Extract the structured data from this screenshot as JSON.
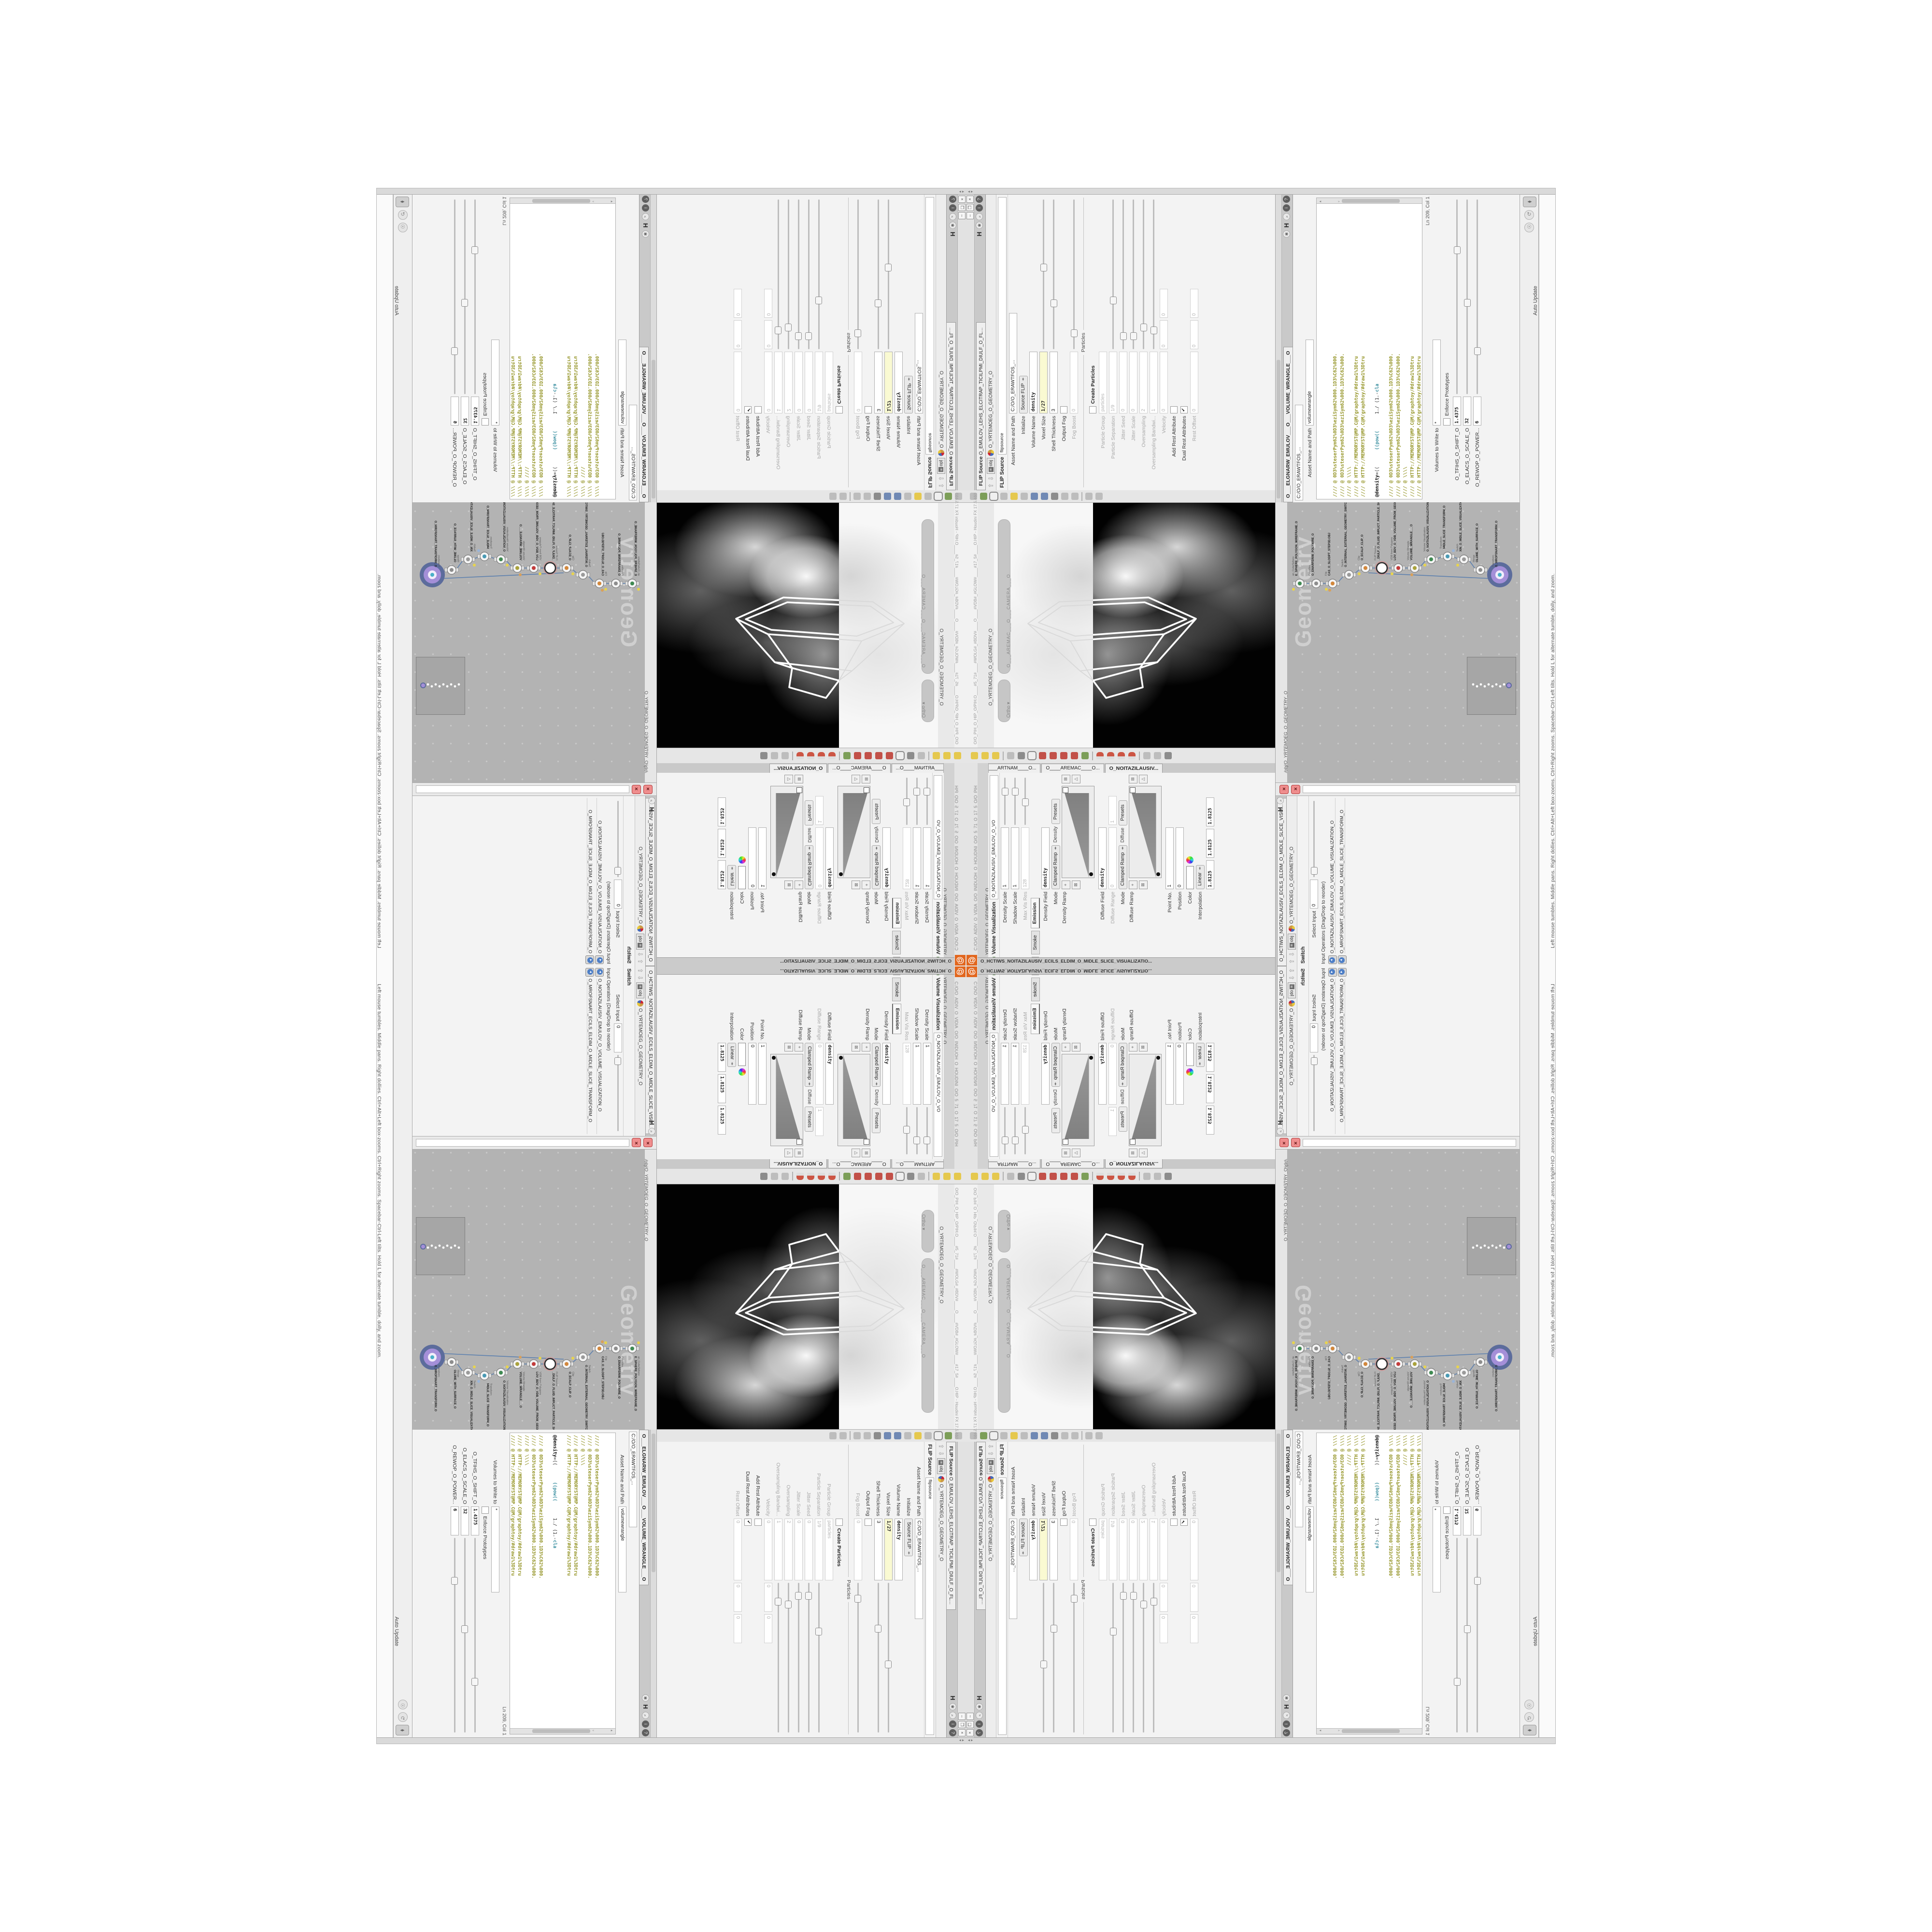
{
  "edges": {
    "help_text": "Left mouse tumbles. Middle pans. Right dollies. Ctrl+Alt+Left box-zooms. Ctrl+Right zooms. Spacebar-Ctrl-Left tilts. Hold L for alternate tumble, dolly, and zoom.",
    "status_path": "C:/O/O_AIDIV_O_VIDIA_O/O_INIDUOH_O_HOUDINI_O/O_5_71_O_17_5_O/O_PIH",
    "auto_update": "Auto Update",
    "scroll_arrows": "◂ ▸"
  },
  "flip_pane": {
    "tab_title": "FLIP Source",
    "tab_name": "O_EMULOV_LEHS_ELCITRAP_TICILPMI_DIULF_O_FLUID_IMPLICIT_PARTICLE_SHEL_VOLUME_O",
    "path_context": "obj",
    "path_label": "O_YRTEMOEG_O_GEOMETRY_O",
    "node_title": "FLIP Source",
    "node_name": "flipsource",
    "rows": [
      {
        "l": "Asset Name and Path",
        "v": "C:/O/O_ERAWTFOS_...",
        "t": "f",
        "wide": true
      },
      {
        "l": "Initialize",
        "v": "Source FLIP",
        "t": "dd"
      },
      {
        "l": "Volume Name",
        "v": "density",
        "t": "f",
        "b": 1
      },
      {
        "l": "Voxel Size",
        "v": "1/27",
        "t": "f",
        "y": 1,
        "s": 0.52
      },
      {
        "l": "Shell Thickness",
        "v": "3",
        "t": "f",
        "s": 0.28
      },
      {
        "l": "Output Fog",
        "t": "c"
      },
      {
        "l": "Fog Boost",
        "v": "0",
        "t": "f",
        "d": 1,
        "s": 0.08
      },
      {
        "l": "Particles",
        "t": "sep"
      },
      {
        "l": "Create Particles",
        "t": "cb"
      },
      {
        "l": "Particle Group",
        "v": "particles",
        "t": "f",
        "d": 1
      },
      {
        "l": "Particle Separation",
        "v": "1/9",
        "t": "f",
        "d": 1,
        "s": 0.3
      },
      {
        "l": "Jitter Seed",
        "v": "0",
        "t": "f",
        "d": 1,
        "s": 0.06
      },
      {
        "l": "Jitter Scale",
        "v": "0",
        "t": "f",
        "d": 1,
        "s": 0.06
      },
      {
        "l": "Oversampling",
        "v": "2",
        "t": "f",
        "d": 1,
        "s": 0.12
      },
      {
        "l": "Oversampling Bandwi...",
        "v": "1",
        "t": "f",
        "d": 1,
        "s": 0.1
      },
      {
        "l": "Velocity",
        "v": "0",
        "v2": [
          "0",
          "0"
        ],
        "t": "f3",
        "d": 1
      },
      {
        "l": "Add Rest Attribute",
        "t": "c"
      },
      {
        "l": "Dual Rest Attributes",
        "t": "c",
        "chk": 1
      },
      {
        "l": "Rest Offset",
        "v": "0",
        "v2": [
          "0",
          "0"
        ],
        "t": "f3",
        "d": 1
      }
    ]
  },
  "wrangle_pane": {
    "tab_name": "O___ELGNARW_EMULOV___O___VOLUME_WRANGLE___O",
    "path_field": "C:/O/O_ERAWTFOS_...",
    "path_context": "obj",
    "path_label": "O_YRTEMOEG_O_GEOMETRY_O",
    "asset_label": "Asset Name and Path",
    "asset_value": "volumewrangle",
    "code_lines": [
      [
        [
          "com",
          "//// @ 0D3%steserPym62%0D3%eziSym62%000.1D3%C62%000."
        ]
      ],
      [
        [
          "com",
          "//// @ 0D3%steserPym62%0D3%eziSym62%000.1D3%C62%000."
        ]
      ],
      [
        [
          "com",
          "//// @ \\\\\\\\"
        ]
      ],
      [
        [
          "com",
          "//// @ HTTP://MEMORYST@MP.C@M/graphtoy/#draw1%3Dtru"
        ]
      ],
      [
        [
          "com",
          "//// @ HTTP://MEMORYST@MP.C@M/graphtoy/#draw1%3Dtru"
        ]
      ],
      [],
      [
        [
          "k",
          "@density"
        ],
        [
          "p",
          "=((      "
        ],
        [
          "fn",
          "((pow(("
        ],
        [
          "p",
          "      1./ (1.-"
        ],
        [
          "fn",
          "cla"
        ]
      ],
      [],
      [
        [
          "com",
          "//// @ 0D3%steserPym62%0D3%eziSym62%000.1D3%C62%000."
        ]
      ],
      [
        [
          "com",
          "//// @ 0D3%steserPym62%0D3%eziSym62%000.1D3%C62%000."
        ]
      ],
      [
        [
          "com",
          "//// @ \\\\\\\\"
        ]
      ],
      [
        [
          "com",
          "//// @ HTTP://MEMORYST@MP.C@M/graphtoy/#draw1%3Dtru"
        ]
      ],
      [
        [
          "com",
          "//// @ HTTP://MEMORYST@MP.C@M/graphtoy/#draw1%3Dtru"
        ]
      ]
    ],
    "status": "Ln 209, Col 1",
    "volumes_label": "Volumes to Write to",
    "volumes_value": "*",
    "enforce_label": "Enforce Prototypes",
    "sliders": [
      {
        "l": "O_TFIHS_O_SHIFT_O",
        "v": "1.4375",
        "s": 0.72
      },
      {
        "l": "O_ELACS_O_SCALE_O",
        "v": "32",
        "s": 0.45
      },
      {
        "l": "O_REWOP_O_POWER...",
        "v": "6",
        "s": 0.2
      }
    ]
  },
  "viewport": {
    "camera_pill": "O___AREMAC___O___CAMERA___O",
    "ortho_label": "Ortho ▾",
    "overlay_text": "O/O_PIH_O_HIP_O/PIH.O____#5_71#____#WOLG#_#BDV#____O____#VDB#_#GLOW#____#17_5#____O.HIP - Houdini FX 17.5.460",
    "path_context": "obj",
    "path_label": "O_YRTEMOEG_O_GEOMETRY_O",
    "toolbar_top": [
      "select-arrow-icon",
      "brush-icon",
      "lock-box-icon",
      "pose-icon",
      "light-bulb-icon",
      "light-bulb2-icon",
      "camera-icon",
      "camera2-icon",
      "render-region-icon",
      "snapshot-icon",
      "material-icon",
      "divider",
      "hand-icon",
      "grid-icon"
    ],
    "toolbar_bottom": [
      "cone-light-icon",
      "diamond-light-icon",
      "sky-light-icon",
      "divider",
      "back-arrow-icon",
      "construction-plane-icon",
      "selection-box-icon",
      "axis-handle-icon",
      "pivot-handle-icon",
      "peak-handle-icon",
      "wire-blast-icon",
      "rgb-axis-icon",
      "divider",
      "magnet-grid-icon",
      "magnet-prim-icon",
      "magnet-point-icon",
      "magnet-multi-icon",
      "divider",
      "forward-arrow-icon",
      "select-visible-icon",
      "compass-icon"
    ]
  },
  "network": {
    "watermark": "Geometry",
    "context_path": "/obj/O_YRTEMOEG_O_GEOMETRY_O",
    "path_context": "obj",
    "nodes": [
      {
        "type": "an_CubeSphere",
        "name": "E_SPHERE_POLYGON_WIREFRAME_O",
        "icon": "#3f8a52"
      },
      {
        "type": "PolyWire",
        "name": "O_EMARFERIW_POLYWIRE_O",
        "icon": "#8d8d8d"
      },
      {
        "type": "File",
        "name": "CAS_O_SLODPT_STEP3D.OBJ",
        "icon": "#d2873c"
      },
      {
        "type": "Switch",
        "name": "O_INTERNAL_EXTERNAL_GEOMETRY_SWITCH_O",
        "icon": "#9a9a9a"
      },
      {
        "type": "Clip",
        "name": "O_ECALP_CLIP_O",
        "icon": "#d2873c"
      },
      {
        "type": "FLIP Source",
        "name": "_DIULF_O_FLUID_IMPLICT_PARTICLE_SHEL_VOLUME_",
        "icon": "ring"
      },
      {
        "type": "VDB from Polygons",
        "name": "LOV_BDV_O_VDB_VOLUME_FROM_GEOMETRY_POLYG",
        "icon": "#c23c3c"
      },
      {
        "type": "Volume Wrangle",
        "name": "VOLUME_WRANGLE___O",
        "icon": "#aaa23c"
      },
      {
        "type": "Volume Visualization",
        "name": "O_NOITAZILAUSIV_VISUALIZATION_O",
        "icon": "#3f8a52"
      },
      {
        "type": "Transform",
        "name": "MIDLE_SLICE_TRANSFORM_O",
        "icon": "#4a9ab4"
      },
      {
        "type": "Switch",
        "name": "XIN_O_MIDLE_SLICE_VISUALIZATION_SWITCH_O",
        "icon": "#9a9a9a"
      },
      {
        "type": "Merge",
        "name": "OLUME_WITH_SURFACE_O",
        "icon": "#8d8d8d"
      },
      {
        "type": "Transform",
        "name": "O_MROFSNART_TRANSFORM_O",
        "icon": "purple"
      }
    ]
  },
  "volviz_pane": {
    "tabs": [
      "O____ARTNAM____O...",
      "O____AREMAC____O...",
      "O_NOITAZILAUSIV..."
    ],
    "active_tab": 2,
    "tab_name": "O_NOITAZILAUSIV_EMULOV_O_VO",
    "path_context": "obj",
    "path_label": "O_YRTEMOEG_O_GEOMETRY_O",
    "node_title": "Volume Visualization",
    "rows": [
      {
        "l": "Density Scale",
        "v": "1",
        "t": "f",
        "s": 0.62
      },
      {
        "l": "Shadow Scale",
        "v": "1",
        "t": "f",
        "s": 0.62
      },
      {
        "l": "Max Vis Res",
        "v": "128",
        "t": "f",
        "d": 1,
        "s": 0.4
      },
      {
        "t": "tabs",
        "tabs": [
          "Smoke",
          "Emission"
        ],
        "active": 1
      },
      {
        "l": "Density Field",
        "v": "density",
        "t": "f",
        "b": 1
      },
      {
        "l": "Mode",
        "v": "Clamped Ramp",
        "t": "mode",
        "extra": "Density",
        "btn": "Presets"
      },
      {
        "l": "Density Ramp",
        "t": "ramp"
      },
      {
        "l": "Diffuse Field",
        "v": "density",
        "t": "f",
        "b": 1
      },
      {
        "l": "Diffuse Range",
        "v": "0",
        "v2": [
          "1"
        ],
        "t": "f3",
        "d": 1
      },
      {
        "l": "Mode",
        "v": "Clamped Ramp",
        "t": "mode",
        "extra": "Diffuse",
        "btn": "Presets"
      },
      {
        "l": "Diffuse Ramp",
        "t": "ramp"
      },
      {
        "l": "Point No.",
        "v": "1",
        "t": "f"
      },
      {
        "l": "Position",
        "v": "0",
        "t": "f"
      },
      {
        "l": "Color",
        "t": "color"
      },
      {
        "l": "Interpolation",
        "v": "Linear",
        "t": "dd"
      },
      {
        "t": "triple",
        "vals": [
          "1.8125",
          "1.8125",
          "1.8125"
        ]
      }
    ],
    "bottom_tab": "O_HCTIWS_NOITAZILAUSIV_ECILS_ELDIM_O_MIDLE_SLICE_VISUALIZATIO..."
  },
  "switch_pane": {
    "tab_name": "O_HCTIWS_NOITAZILAUSIV_ECILS_ELDIM_O_MIDLE_SLICE_VISUALIZATION_SWITCH_O",
    "path_context": "obj",
    "path_label": "O_YRTEMOEG_O_GEOMETRY_O",
    "node_title": "Switch",
    "select_label": "Select Input",
    "select_value": "0",
    "operators_label": "Input Operators (Drag/Drop to reorder)",
    "items": [
      "O_NOITAZILAUSIV_EMULOV_O_VOLUME_VISUALIZATION_O",
      "O_MROFSNART_ECILS_ELDIM_O_MIDLE_SLICE_TRANSFORM_O"
    ]
  },
  "colors": {
    "accent_orange": "#e2661d",
    "node_purple": "#a48fd8",
    "node_ring_blue": "#5c6c9c",
    "code_comment": "#96962a",
    "code_func": "#3a8fa0",
    "highlight_field": "#fafad2",
    "red_close": "#ef8d8d",
    "net_bg": "#b3b3b3"
  }
}
